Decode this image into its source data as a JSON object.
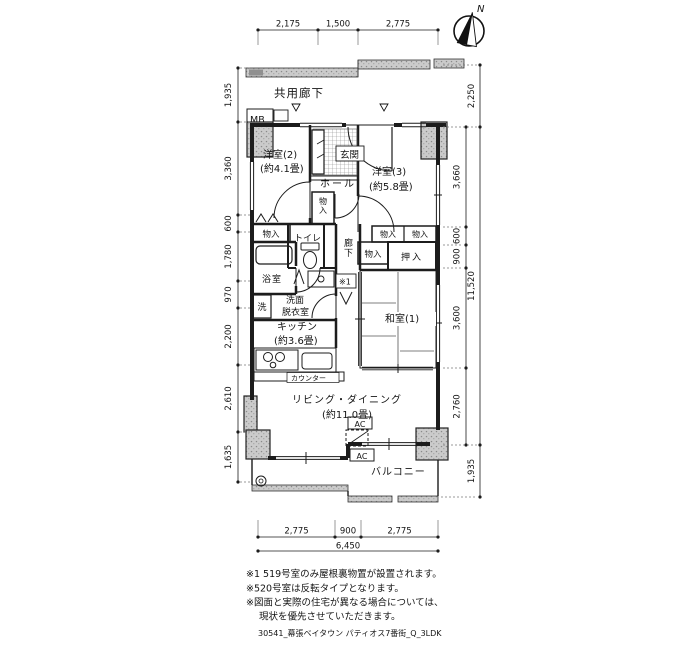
{
  "compass": {
    "north_label": "N"
  },
  "header": {
    "common_corridor": "共用廊下",
    "mb_label": "MB"
  },
  "rooms": {
    "entrance": "玄関",
    "hall": "ホール",
    "western_room_2": {
      "name": "洋室(2)",
      "size": "(約4.1畳)"
    },
    "western_room_3": {
      "name": "洋室(3)",
      "size": "(約5.8畳)"
    },
    "japanese_room": {
      "name": "和室(1)"
    },
    "living_dining": {
      "name": "リビング・ダイニング",
      "size": "(約11.0畳)"
    },
    "kitchen": {
      "name": "キッチン",
      "size": "(約3.6畳)",
      "counter": "カウンター"
    },
    "toilet": "トイレ",
    "bath": "浴室",
    "washroom": {
      "line1": "洗面",
      "line2": "脱衣室",
      "washer": "洗"
    },
    "corridor": "廊下",
    "balcony": "バルコニー",
    "closet": "物入",
    "oshiire": "押入",
    "ac": "AC",
    "attic_marker": "※1"
  },
  "dimensions": {
    "top": [
      "2,175",
      "1,500",
      "2,775"
    ],
    "left": [
      "1,935",
      "3,360",
      "600",
      "1,780",
      "970",
      "2,200",
      "2,610",
      "1,635"
    ],
    "right_inner": [
      "3,660",
      "600",
      "900",
      "3,600",
      "2,760"
    ],
    "right_outer": [
      "2,250",
      "11,520",
      "1,935"
    ],
    "bottom": [
      "2,775",
      "900",
      "2,775"
    ],
    "bottom_total": "6,450"
  },
  "notes": [
    "※1 519号室のみ屋根裏物置が設置されます。",
    "※520号室は反転タイプとなります。",
    "※図面と実際の住宅が異なる場合については、",
    "現状を優先させていただきます。"
  ],
  "footer": "30541_幕張ベイタウン パティオス7番街_Q_3LDK",
  "colors": {
    "line": "#1c1c1c",
    "concrete": "#c6c6c6",
    "background": "#ffffff"
  }
}
